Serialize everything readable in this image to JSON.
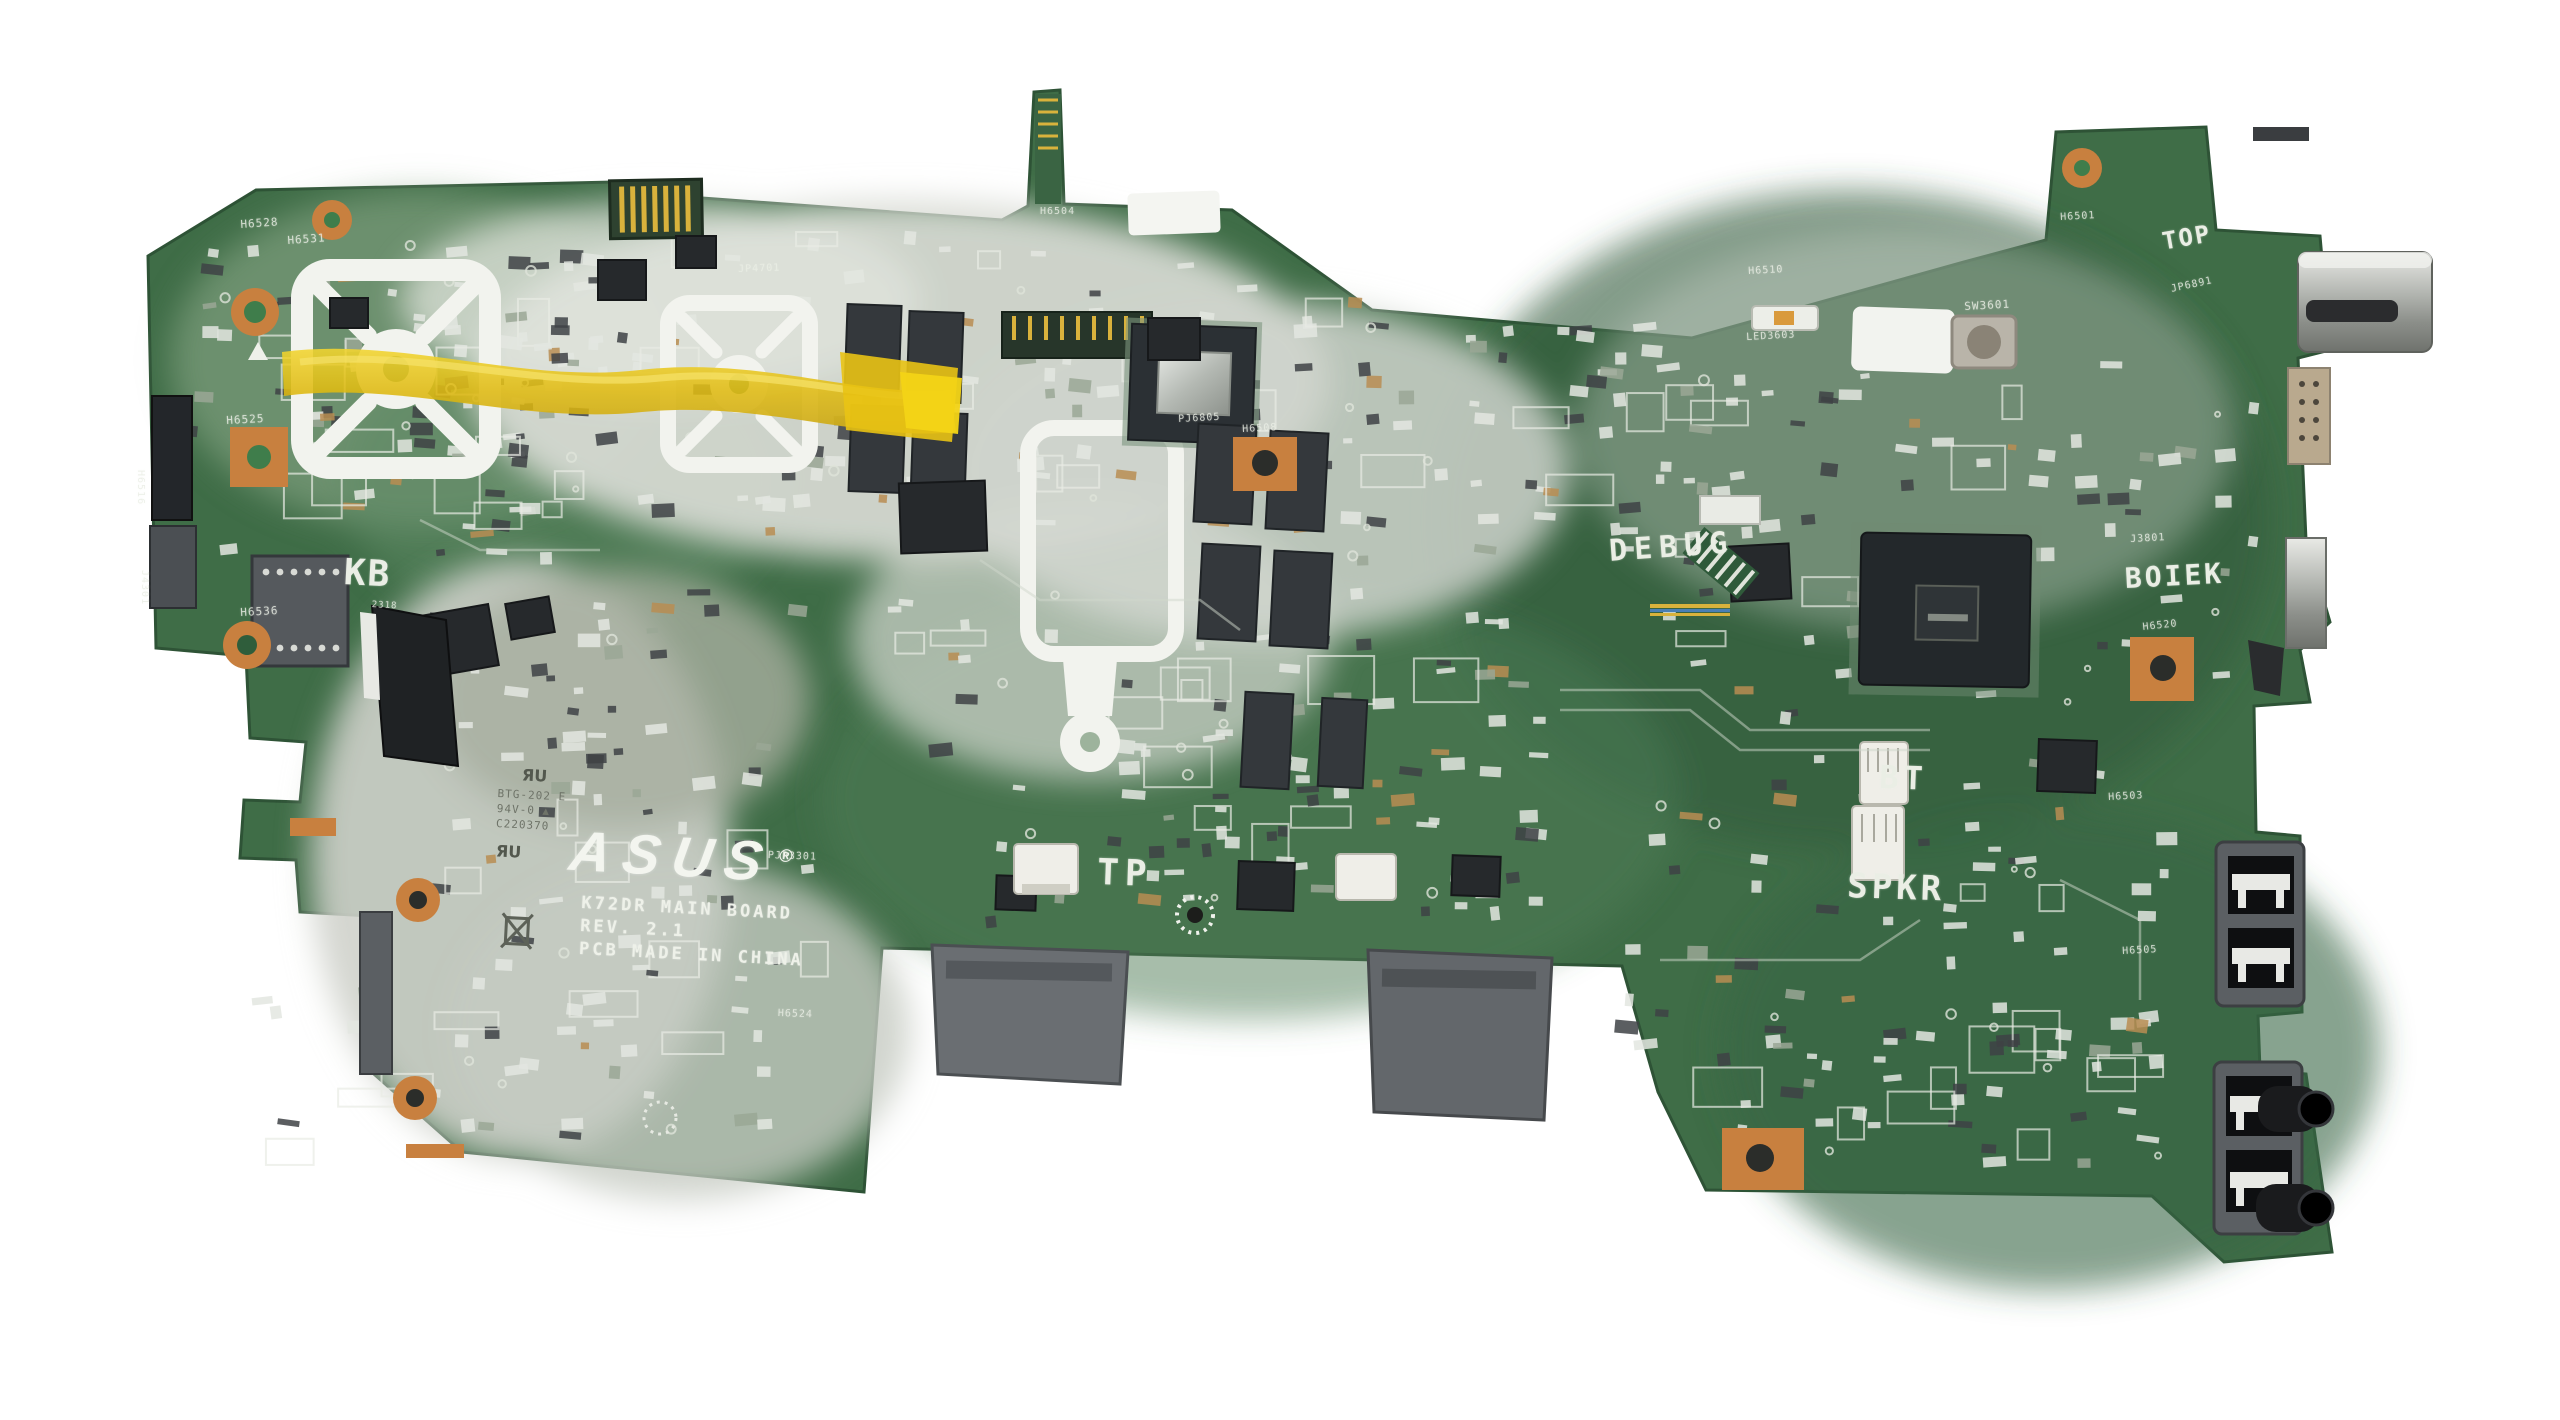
{
  "image": {
    "width": 2560,
    "height": 1420,
    "background": "#ffffff"
  },
  "board": {
    "brand_logo": "ASUS",
    "brand_reg": "®",
    "model_line1": "K72DR MAIN BOARD",
    "model_line2": "REV. 2.1",
    "model_line3": "PCB MADE IN CHINA",
    "cert_line1": "BTG-202 E",
    "cert_line2": "94V-0 ▲",
    "cert_line3": "C220370",
    "ul_mark": "ЯU"
  },
  "port_labels": [
    {
      "id": "kb",
      "text": "KB",
      "x": 345,
      "y": 552,
      "size": 36,
      "rot": 3,
      "ls": 2
    },
    {
      "id": "tp",
      "text": "TP",
      "x": 1098,
      "y": 852,
      "size": 36,
      "rot": 2,
      "ls": 6
    },
    {
      "id": "debug",
      "text": "DEBUG",
      "x": 1608,
      "y": 534,
      "size": 30,
      "rot": -4,
      "ls": 7
    },
    {
      "id": "bt",
      "text": "BT",
      "x": 1880,
      "y": 758,
      "size": 32,
      "rot": 2,
      "ls": 5
    },
    {
      "id": "spkr",
      "text": "SPKR",
      "x": 1848,
      "y": 866,
      "size": 34,
      "rot": 2,
      "ls": 4
    },
    {
      "id": "boiek",
      "text": "BOIEK",
      "x": 2124,
      "y": 562,
      "size": 28,
      "rot": -3,
      "ls": 3
    },
    {
      "id": "top",
      "text": "TOP",
      "x": 2160,
      "y": 228,
      "size": 24,
      "rot": -10,
      "ls": 2
    }
  ],
  "ref_labels": [
    {
      "id": "h6528",
      "text": "H6528",
      "x": 240,
      "y": 218,
      "size": 11,
      "rot": -4
    },
    {
      "id": "h6531",
      "text": "H6531",
      "x": 287,
      "y": 234,
      "size": 11,
      "rot": -4
    },
    {
      "id": "h6525",
      "text": "H6525",
      "x": 226,
      "y": 414,
      "size": 11,
      "rot": -3
    },
    {
      "id": "h6536",
      "text": "H6536",
      "x": 240,
      "y": 606,
      "size": 11,
      "rot": -3
    },
    {
      "id": "h6516",
      "text": "H6516",
      "x": 146,
      "y": 470,
      "size": 10,
      "rot": 90
    },
    {
      "id": "j4301",
      "text": "J4301",
      "x": 150,
      "y": 570,
      "size": 10,
      "rot": 90
    },
    {
      "id": "jp4701",
      "text": "JP4701",
      "x": 738,
      "y": 264,
      "size": 10,
      "rot": -2
    },
    {
      "id": "h6504",
      "text": "H6504",
      "x": 1040,
      "y": 206,
      "size": 10,
      "rot": 0
    },
    {
      "id": "pj6805",
      "text": "PJ6805",
      "x": 1178,
      "y": 414,
      "size": 10,
      "rot": -3
    },
    {
      "id": "h6508",
      "text": "H6508",
      "x": 1242,
      "y": 424,
      "size": 10,
      "rot": -3
    },
    {
      "id": "h6510",
      "text": "H6510",
      "x": 1748,
      "y": 266,
      "size": 10,
      "rot": -3
    },
    {
      "id": "led3603",
      "text": "LED3603",
      "x": 1746,
      "y": 332,
      "size": 10,
      "rot": -3
    },
    {
      "id": "sw3601",
      "text": "SW3601",
      "x": 1964,
      "y": 300,
      "size": 11,
      "rot": -3
    },
    {
      "id": "h6501",
      "text": "H6501",
      "x": 2060,
      "y": 212,
      "size": 10,
      "rot": -3
    },
    {
      "id": "jp6891",
      "text": "JP6891",
      "x": 2170,
      "y": 284,
      "size": 10,
      "rot": -12
    },
    {
      "id": "j3801",
      "text": "J3801",
      "x": 2130,
      "y": 534,
      "size": 10,
      "rot": -3
    },
    {
      "id": "h6520",
      "text": "H6520",
      "x": 2142,
      "y": 622,
      "size": 10,
      "rot": -6
    },
    {
      "id": "h6503",
      "text": "H6503",
      "x": 2108,
      "y": 792,
      "size": 10,
      "rot": -3
    },
    {
      "id": "h6505",
      "text": "H6505",
      "x": 2122,
      "y": 946,
      "size": 10,
      "rot": -3
    },
    {
      "id": "h6524",
      "text": "H6524",
      "x": 778,
      "y": 1008,
      "size": 10,
      "rot": 2
    },
    {
      "id": "pjp3301",
      "text": "PJP3301",
      "x": 768,
      "y": 850,
      "size": 10,
      "rot": 2
    },
    {
      "id": "kb2318",
      "text": "2318",
      "x": 372,
      "y": 600,
      "size": 9,
      "rot": 3
    }
  ],
  "palette": {
    "pcb_dark": "#2f5d3b",
    "pcb_mid": "#41704a",
    "pcb_light": "#7ba37e",
    "foil_gray": "#d4d7d1",
    "tape_yellow": "#e6c31c",
    "copper": "#c8803f",
    "silkscreen": "#eaeee5",
    "chip_black": "#2b2f33",
    "die_silver": "#b9bdb9",
    "connector_gray": "#63676b",
    "gold_pin": "#d9b23c"
  }
}
